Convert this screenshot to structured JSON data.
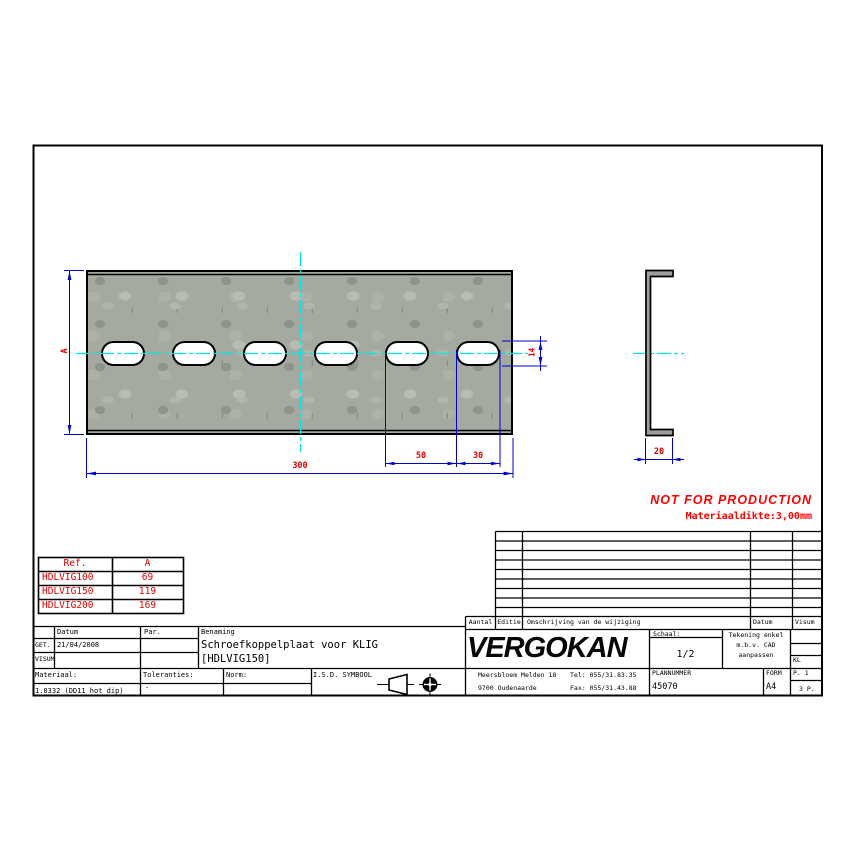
{
  "drawing": {
    "dim_a": "A",
    "dim_length": "300",
    "dim_pitch": "50",
    "dim_slot_length": "30",
    "dim_slot_height": "14",
    "dim_profile_width": "20",
    "warning": "NOT FOR PRODUCTION",
    "material_note": "Materiaaldikte:3,00mm",
    "colors": {
      "dimension_blue": "#0000cc",
      "centerline_cyan": "#00e6e6",
      "label_red": "#e00000",
      "warning_red": "#ff0000",
      "plate_gray": "#a5aaa1"
    }
  },
  "ref_table": {
    "headers": [
      "Ref.",
      "A"
    ],
    "rows": [
      [
        "HDLVIG100",
        "69"
      ],
      [
        "HDLVIG150",
        "119"
      ],
      [
        "HDLVIG200",
        "169"
      ]
    ]
  },
  "title_block": {
    "left": {
      "datum_label": "Datum",
      "par_label": "Par.",
      "benaming_label": "Benaming",
      "get_label": "GET.",
      "visum_label": "VISUM",
      "date_value": "21/04/2008",
      "benaming_line1": "Schroefkoppelplaat voor KLIG",
      "benaming_line2": "[HDLVIG150]",
      "materiaal_label": "Materiaal:",
      "materiaal_value": "1.0332 (DD11 hot dip)",
      "toleranties_label": "Toleranties:",
      "toleranties_value": "-",
      "norm_label": "Norm:",
      "isd_label": "I.S.D. SYMBOOL"
    },
    "revision_header": {
      "aantal": "Aantal",
      "editie": "Editie",
      "omschrijving": "Omschrijving van de wijziging",
      "datum": "Datum",
      "visum": "Visum"
    },
    "right": {
      "logo": "VERGOKAN",
      "schaal_label": "Schaal:",
      "schaal_value": "1/2",
      "note_line1": "Tekening enkel",
      "note_line2": "m.b.v. CAD",
      "note_line3": "aanpassen",
      "kl": "KL",
      "address_line1": "Meersbloem Melden 18",
      "address_line2": "9700 Oudenaarde",
      "tel": "Tel: 055/31.83.35",
      "fax": "Fax: 055/31.43.88",
      "plannummer_label": "PLANNUMMER",
      "plannummer_value": "45070",
      "form_label": "FORM",
      "form_value": "A4",
      "page_ref": "P. 1",
      "page_count": "3 P."
    }
  }
}
